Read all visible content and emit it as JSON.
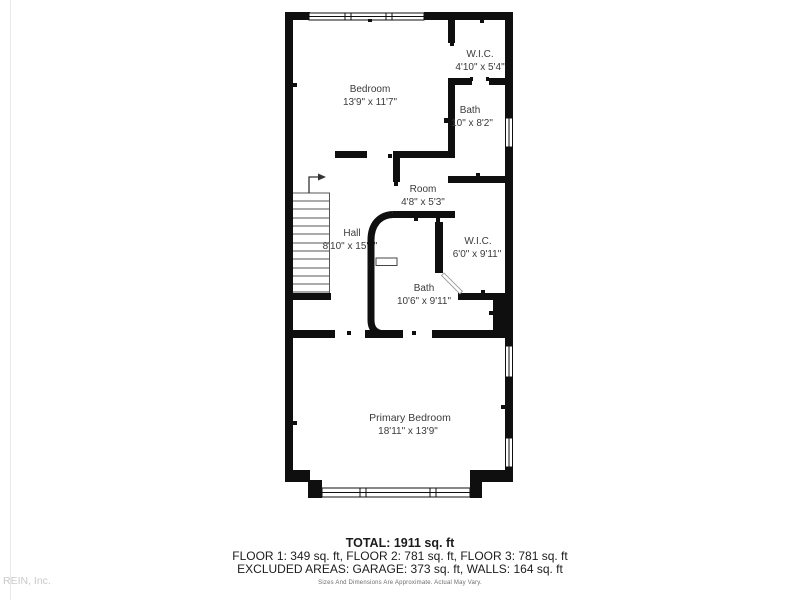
{
  "watermark": "REIN, Inc.",
  "plan": {
    "wall_color": "#0f0f0f",
    "rooms": {
      "bedroom": {
        "name": "Bedroom",
        "dims": "13'9\" x 11'7\""
      },
      "wic_upper": {
        "name": "W.I.C.",
        "dims": "4'10\" x 5'4\""
      },
      "bath_upper": {
        "name": "Bath",
        "dims": "10\" x 8'2\""
      },
      "room": {
        "name": "Room",
        "dims": "4'8\" x 5'3\""
      },
      "hall": {
        "name": "Hall",
        "dims": "8'10\" x 15'1\""
      },
      "wic_mid": {
        "name": "W.I.C.",
        "dims": "6'0\" x 9'11\""
      },
      "bath_mid": {
        "name": "Bath",
        "dims": "10'6\" x 9'11\""
      },
      "primary_bedroom": {
        "name": "Primary Bedroom",
        "dims": "18'11\" x 13'9\""
      }
    }
  },
  "summary": {
    "total": "TOTAL: 1911 sq. ft",
    "floors": "FLOOR 1: 349 sq. ft, FLOOR 2: 781 sq. ft, FLOOR 3: 781 sq. ft",
    "excluded": "EXCLUDED AREAS: GARAGE: 373 sq. ft, WALLS: 164 sq. ft",
    "disclaimer": "Sizes And Dimensions Are Approximate. Actual May Vary."
  }
}
